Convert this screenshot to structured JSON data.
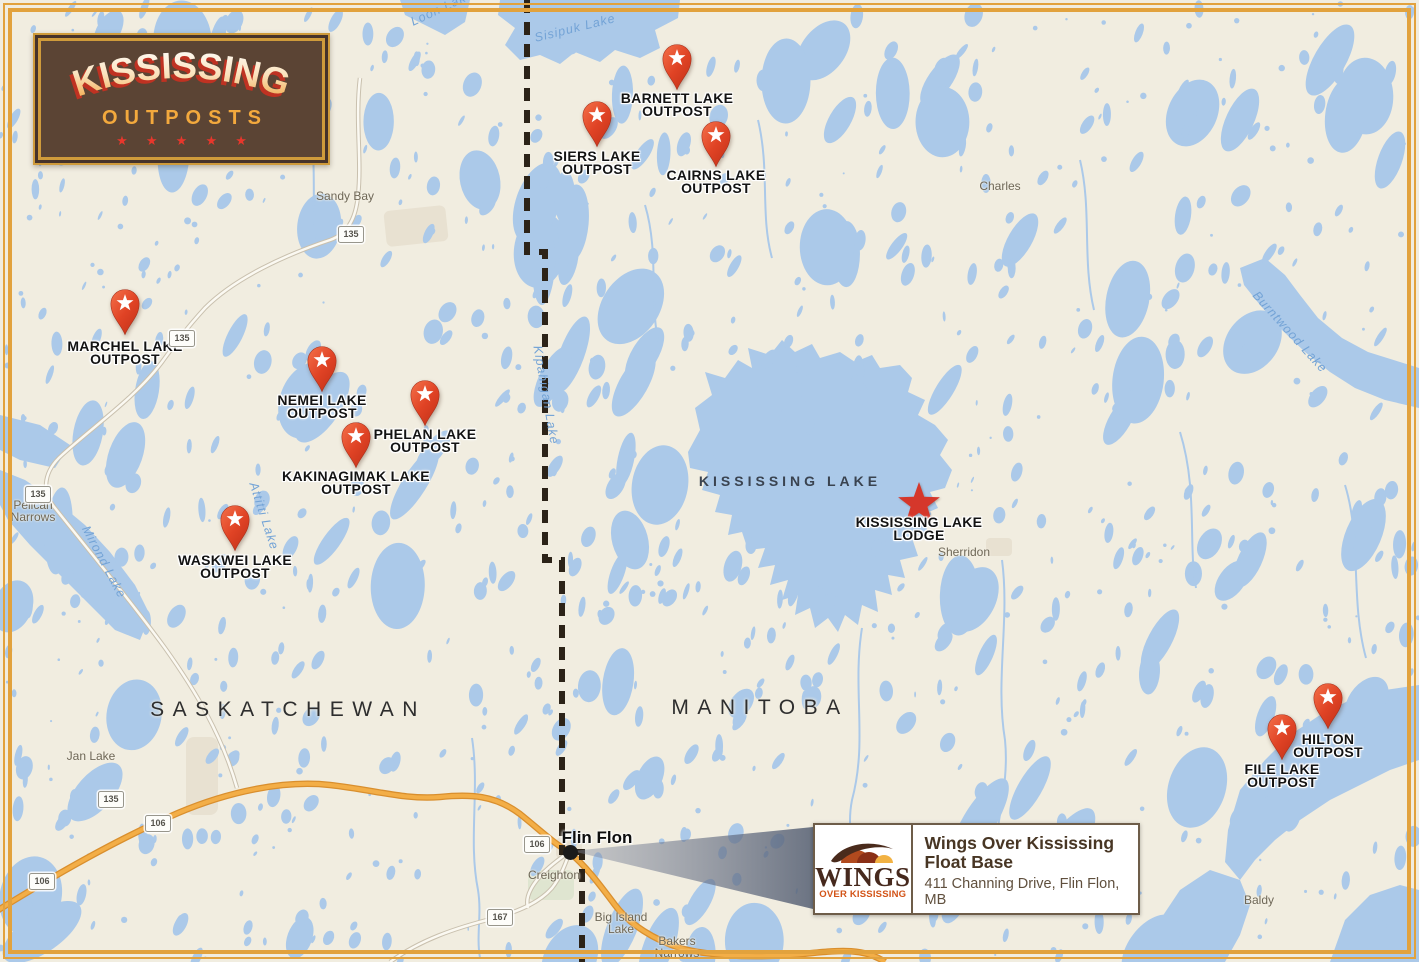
{
  "brand": {
    "title": "KISSISSING",
    "subtitle": "OUTPOSTS",
    "stars": "★ ★ ★ ★ ★"
  },
  "regions": [
    {
      "label": "SASKATCHEWAN",
      "x": 288,
      "y": 698
    },
    {
      "label": "MANITOBA",
      "x": 760,
      "y": 696
    }
  ],
  "lake_title": {
    "label": "KISSISSING LAKE",
    "x": 790,
    "y": 473
  },
  "outposts": [
    {
      "lines": [
        "BARNETT LAKE",
        "OUTPOST"
      ],
      "x": 677,
      "tip_y": 89,
      "label_y": 92
    },
    {
      "lines": [
        "SIERS LAKE",
        "OUTPOST"
      ],
      "x": 597,
      "tip_y": 146,
      "label_y": 150
    },
    {
      "lines": [
        "CAIRNS LAKE",
        "OUTPOST"
      ],
      "x": 716,
      "tip_y": 166,
      "label_y": 169
    },
    {
      "lines": [
        "MARCHEL LAKE",
        "OUTPOST"
      ],
      "x": 125,
      "tip_y": 334,
      "label_y": 340
    },
    {
      "lines": [
        "NEMEI LAKE",
        "OUTPOST"
      ],
      "x": 322,
      "tip_y": 391,
      "label_y": 394
    },
    {
      "lines": [
        "PHELAN LAKE",
        "OUTPOST"
      ],
      "x": 425,
      "tip_y": 425,
      "label_y": 428
    },
    {
      "lines": [
        "KAKINAGIMAK LAKE",
        "OUTPOST"
      ],
      "x": 356,
      "tip_y": 467,
      "label_y": 470
    },
    {
      "lines": [
        "WASKWEI LAKE",
        "OUTPOST"
      ],
      "x": 235,
      "tip_y": 550,
      "label_y": 554
    },
    {
      "lines": [
        "HILTON",
        "OUTPOST"
      ],
      "x": 1328,
      "tip_y": 728,
      "label_y": 733
    },
    {
      "lines": [
        "FILE LAKE",
        "OUTPOST"
      ],
      "x": 1282,
      "tip_y": 759,
      "label_y": 763
    }
  ],
  "lodge": {
    "lines": [
      "KISSISSING LAKE",
      "LODGE"
    ],
    "x": 919,
    "y": 503,
    "label_y": 516
  },
  "city": {
    "label": "Flin Flon",
    "x": 597,
    "y": 828,
    "dot_x": 570,
    "dot_y": 852
  },
  "towns": [
    {
      "lines": [
        "Sandy Bay"
      ],
      "x": 345,
      "y": 191
    },
    {
      "lines": [
        "Charles"
      ],
      "x": 1000,
      "y": 181
    },
    {
      "lines": [
        "Pelican",
        "Narrows"
      ],
      "x": 33,
      "y": 500
    },
    {
      "lines": [
        "Sherridon"
      ],
      "x": 964,
      "y": 547
    },
    {
      "lines": [
        "Jan Lake"
      ],
      "x": 91,
      "y": 751
    },
    {
      "lines": [
        "Creighton"
      ],
      "x": 554,
      "y": 870
    },
    {
      "lines": [
        "Big Island",
        "Lake"
      ],
      "x": 621,
      "y": 912
    },
    {
      "lines": [
        "Bakers",
        "Narrows"
      ],
      "x": 677,
      "y": 936
    },
    {
      "lines": [
        "Baldy"
      ],
      "x": 1259,
      "y": 895
    }
  ],
  "lakes": [
    {
      "label": "Sisipuk Lake",
      "x": 575,
      "y": 28,
      "rot": -14
    },
    {
      "label": "Loon Lake",
      "x": 442,
      "y": 8,
      "rot": -25
    },
    {
      "label": "Kipahigan Lake",
      "x": 546,
      "y": 395,
      "rot": 80
    },
    {
      "label": "Attitti Lake",
      "x": 264,
      "y": 516,
      "rot": 72
    },
    {
      "label": "Mirond Lake",
      "x": 104,
      "y": 562,
      "rot": 62
    },
    {
      "label": "Burntwood Lake",
      "x": 1290,
      "y": 332,
      "rot": 48
    }
  ],
  "shields": [
    {
      "n": "135",
      "x": 350,
      "y": 233
    },
    {
      "n": "135",
      "x": 181,
      "y": 337
    },
    {
      "n": "135",
      "x": 37,
      "y": 493
    },
    {
      "n": "135",
      "x": 110,
      "y": 798
    },
    {
      "n": "106",
      "x": 157,
      "y": 822
    },
    {
      "n": "106",
      "x": 41,
      "y": 880
    },
    {
      "n": "106",
      "x": 536,
      "y": 843
    },
    {
      "n": "167",
      "x": 499,
      "y": 916
    }
  ],
  "info_box": {
    "logo_title": "WINGS",
    "logo_sub": "OVER KISSISSING",
    "line1": "Wings Over Kississing",
    "line2": "Float Base",
    "address": "411 Channing Drive, Flin Flon, MB"
  },
  "colors": {
    "water": "#abc9e9",
    "land": "#f1ede0",
    "pin_red": "#e04325",
    "frame_gold": "#e2a23d",
    "brand_brown": "#5b4434",
    "road_major": "#f3ae47",
    "lodge_star": "#d5372b"
  }
}
